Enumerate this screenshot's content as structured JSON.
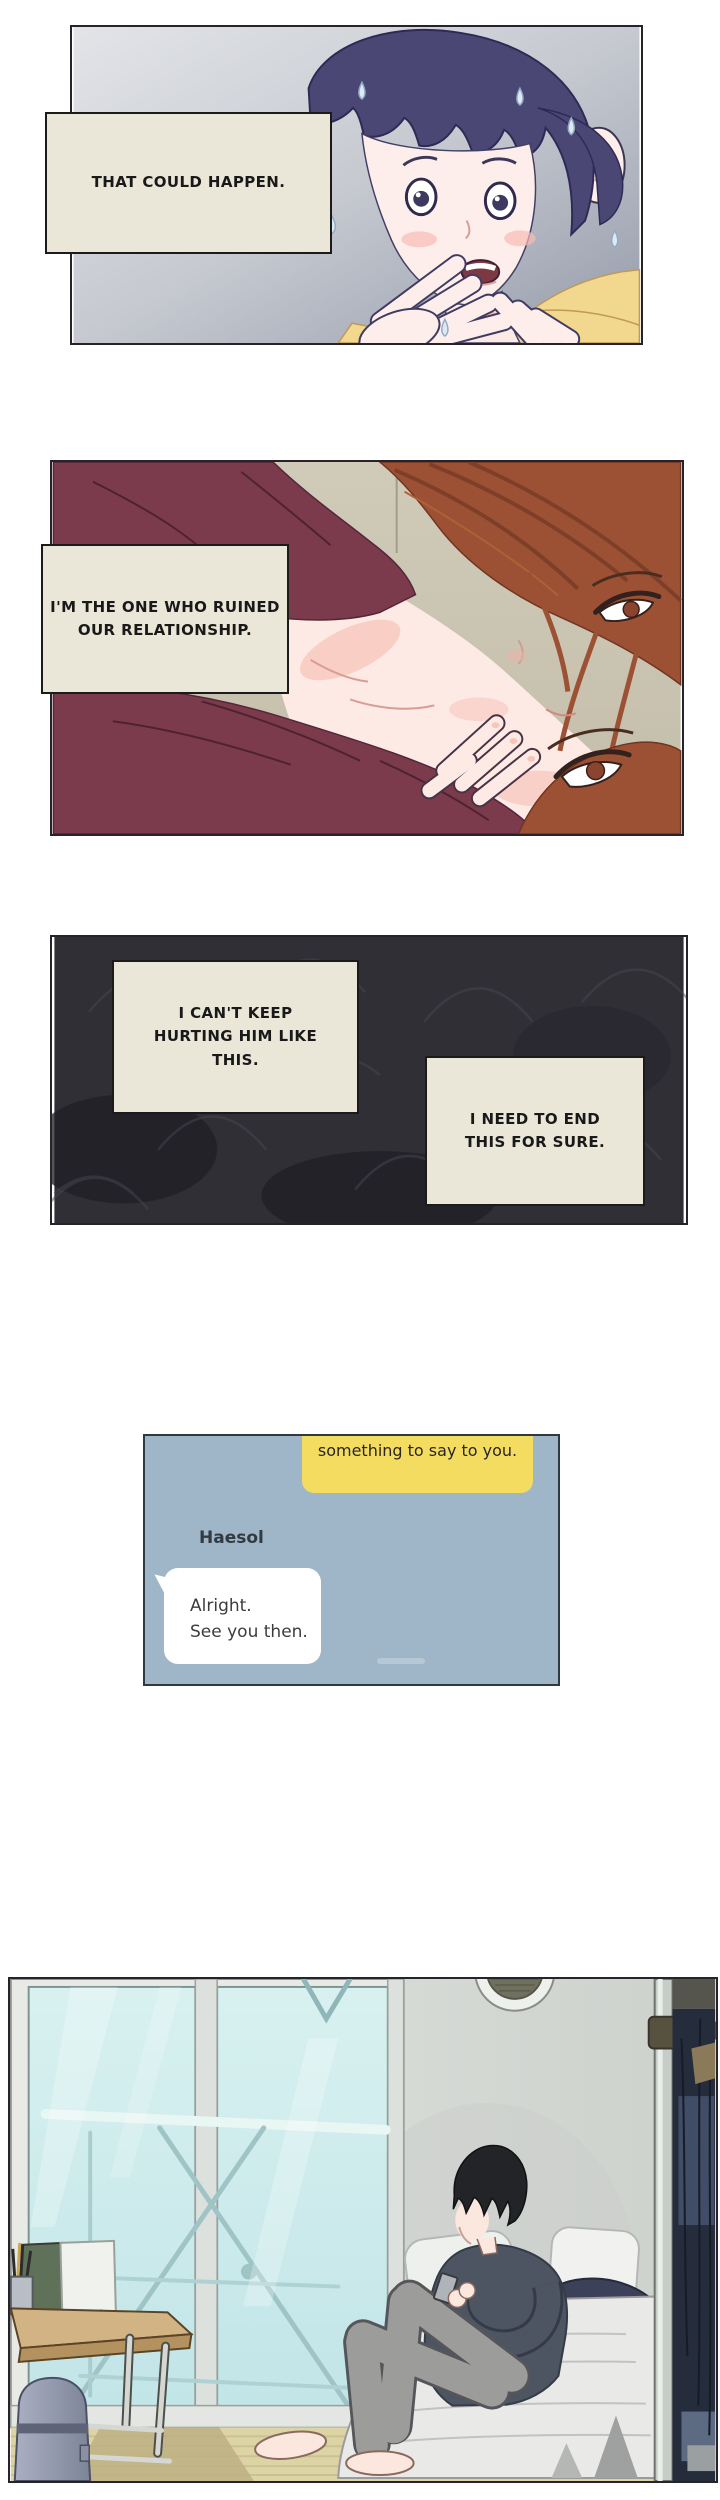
{
  "comic": {
    "panel1": {
      "caption": "THAT COULD HAPPEN."
    },
    "panel2": {
      "caption": "I'M THE ONE WHO RUINED\nOUR RELATIONSHIP."
    },
    "panel3": {
      "caption_left": "I CAN'T KEEP\nHURTING HIM LIKE\nTHIS.",
      "caption_right": "I NEED TO END\nTHIS FOR SURE."
    },
    "chat": {
      "contact_name": "Haesol",
      "outgoing_message": "something to say to you.",
      "reply_message": "Alright.\nSee you then."
    }
  },
  "colors": {
    "caption_box_bg": "#ebe7d8",
    "caption_border": "#1b1b1b",
    "panel1_bg_gradient": [
      "#e0e2e6",
      "#969cab"
    ],
    "panel2_wall": "#cbc5b1",
    "panel2_clothing": "#7b3b4d",
    "panel2_hair": "#9d5134",
    "panel3_bg": "#312f36",
    "chat_bg": "#9eb6c7",
    "outgoing_bubble": "#f4dc60",
    "reply_bubble": "#ffffff",
    "room_glass": "#cdeaec",
    "room_wall": "#dfe2de",
    "room_floor_mat": "#ddd4a6",
    "bed_sheet": "#e9e9e7",
    "sweater": "#4d5462"
  }
}
